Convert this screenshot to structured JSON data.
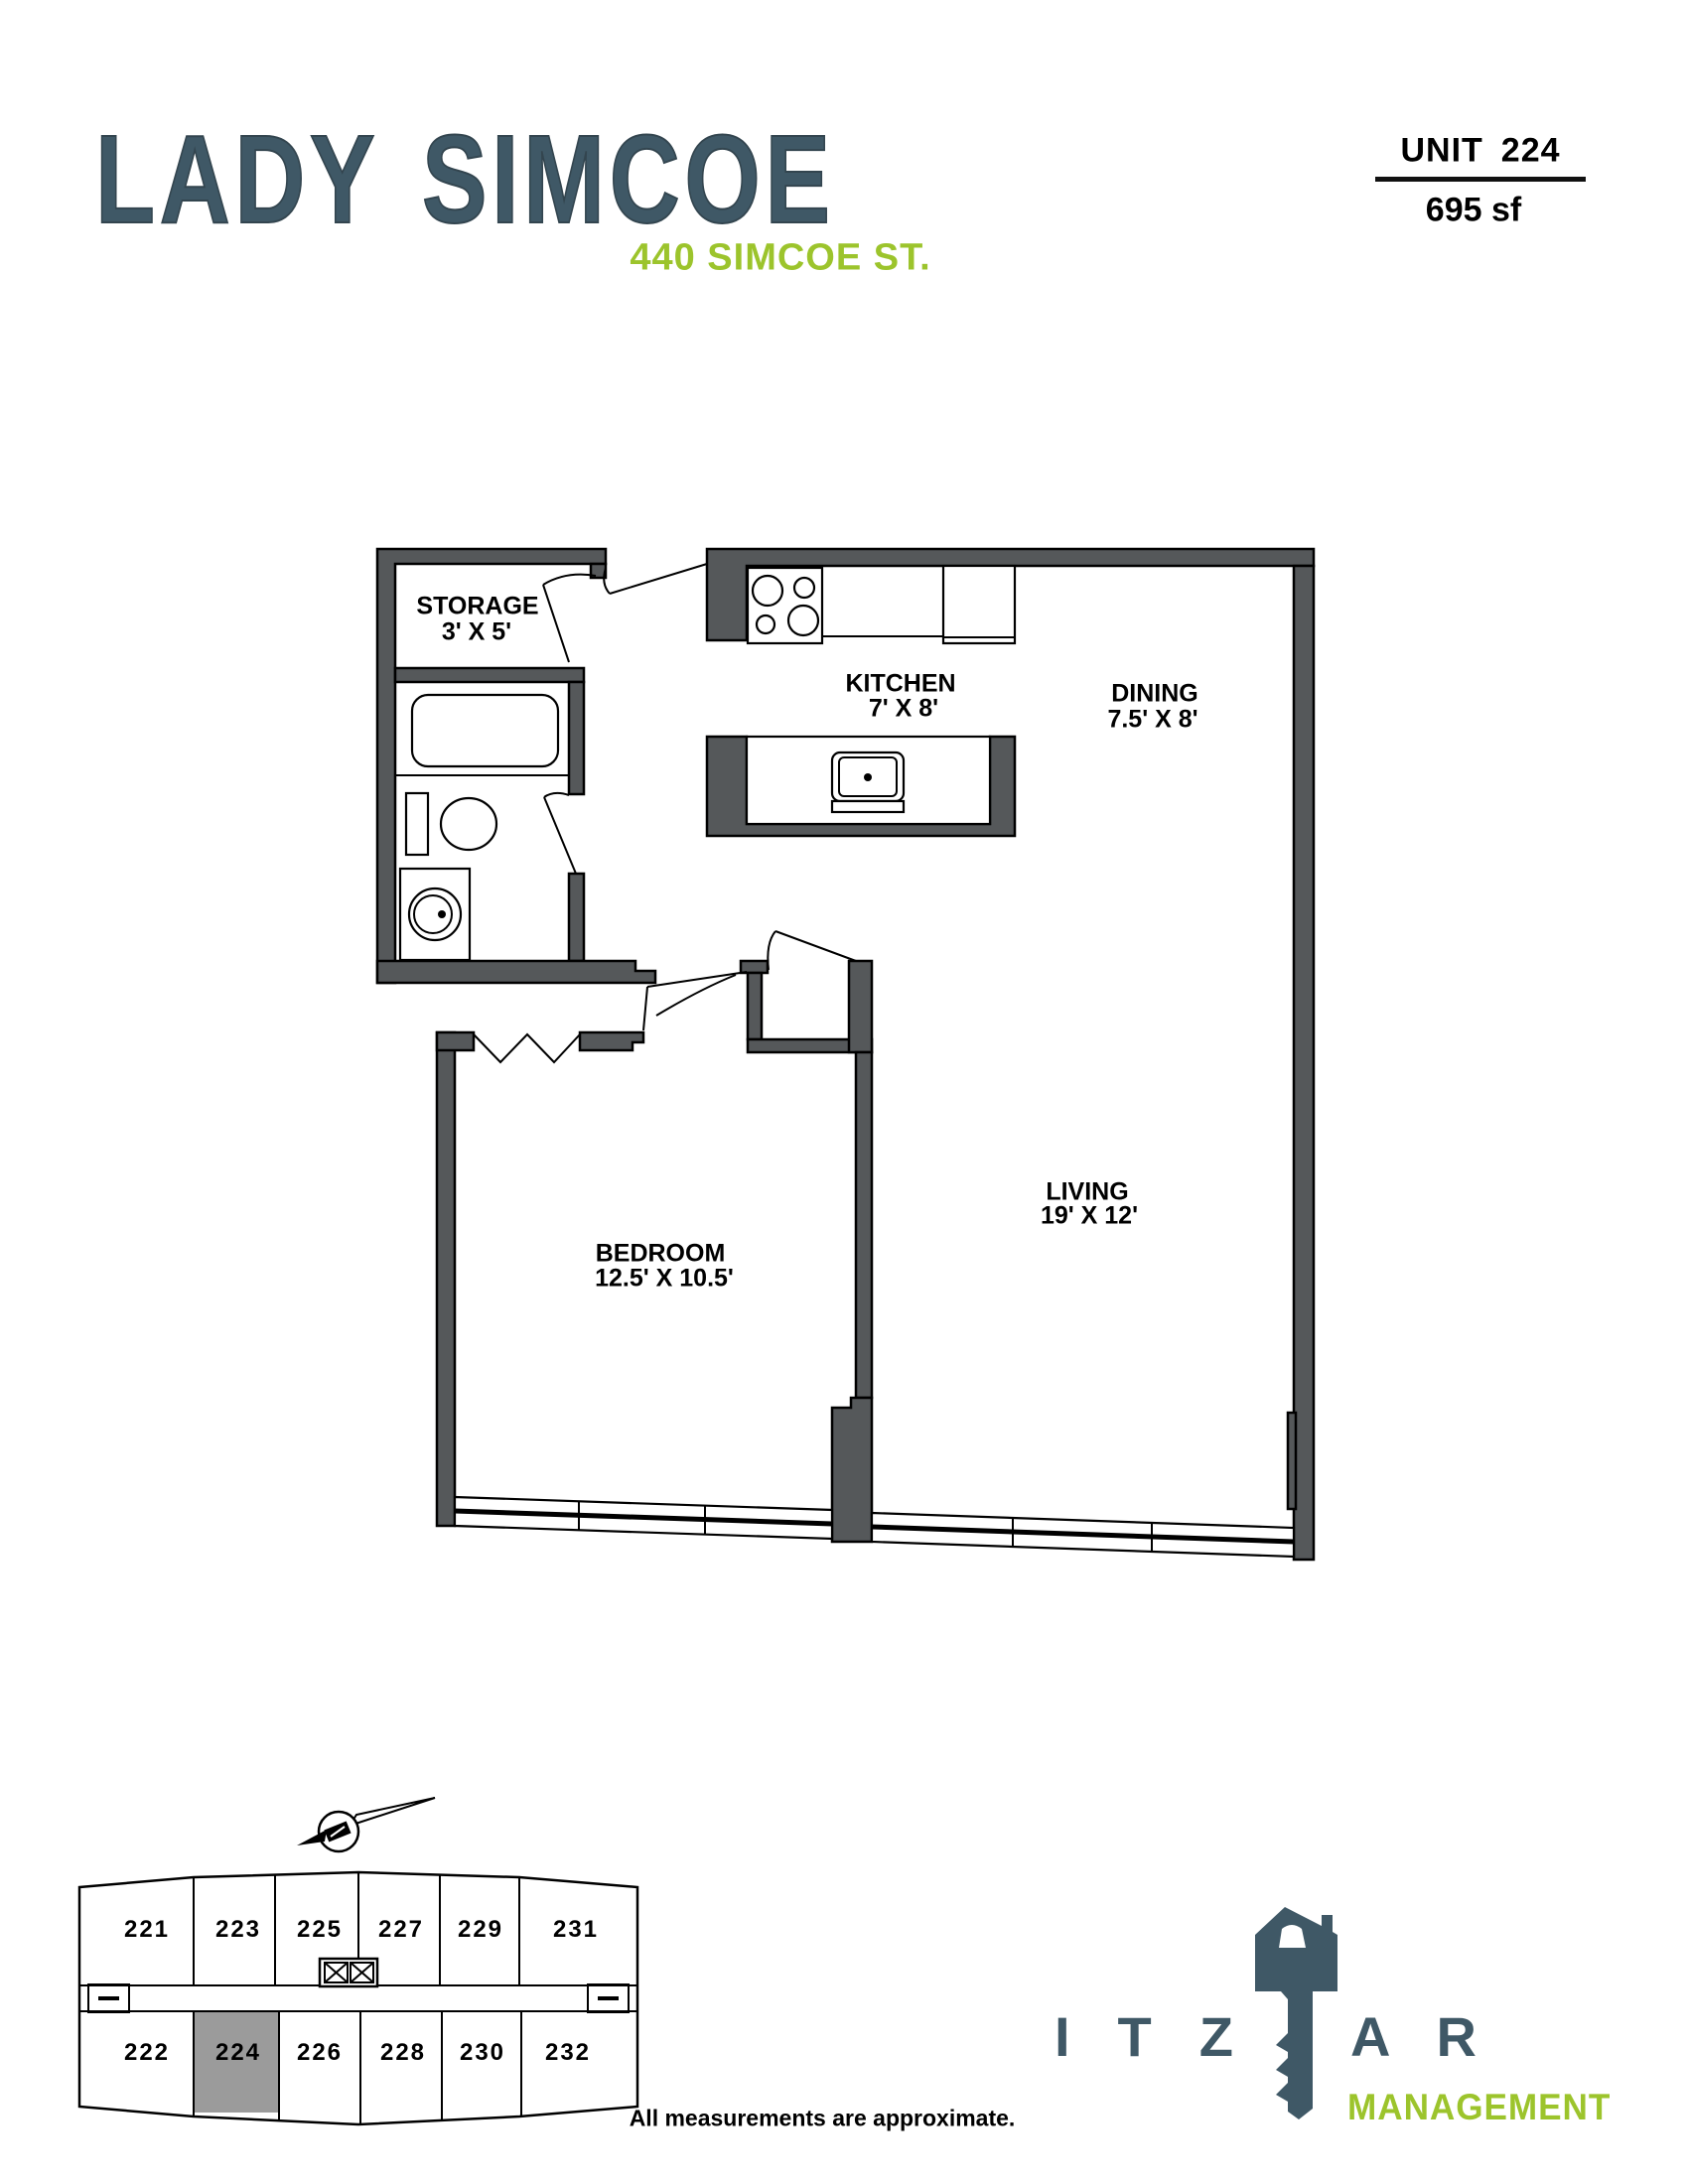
{
  "header": {
    "building_name": "LADY SIMCOE",
    "address": "440 SIMCOE ST.",
    "unit_word": "UNIT",
    "unit_number": "224",
    "area": "695 sf"
  },
  "floor_plan": {
    "rooms": [
      {
        "name": "STORAGE",
        "dims": "3' X 5'"
      },
      {
        "name": "KITCHEN",
        "dims": "7' X 8'"
      },
      {
        "name": "DINING",
        "dims": "7.5' X 8'"
      },
      {
        "name": "BEDROOM",
        "dims": "12.5' X 10.5'"
      },
      {
        "name": "LIVING",
        "dims": "19' X 12'"
      }
    ]
  },
  "key_plan": {
    "top_units": [
      "221",
      "223",
      "225",
      "227",
      "229",
      "231"
    ],
    "bottom_units": [
      "222",
      "224",
      "226",
      "228",
      "230",
      "232"
    ],
    "highlighted_unit": "224",
    "highlight_color": "#9B9B9B"
  },
  "branding": {
    "logo_left": "ITZ",
    "logo_right": "AR",
    "logo_sub": "MANAGEMENT"
  },
  "footer": {
    "disclaimer": "All measurements are approximate."
  },
  "colors": {
    "brand_slate": "#3F5866",
    "brand_green": "#9CC42C",
    "wall_gray": "#55585A"
  }
}
